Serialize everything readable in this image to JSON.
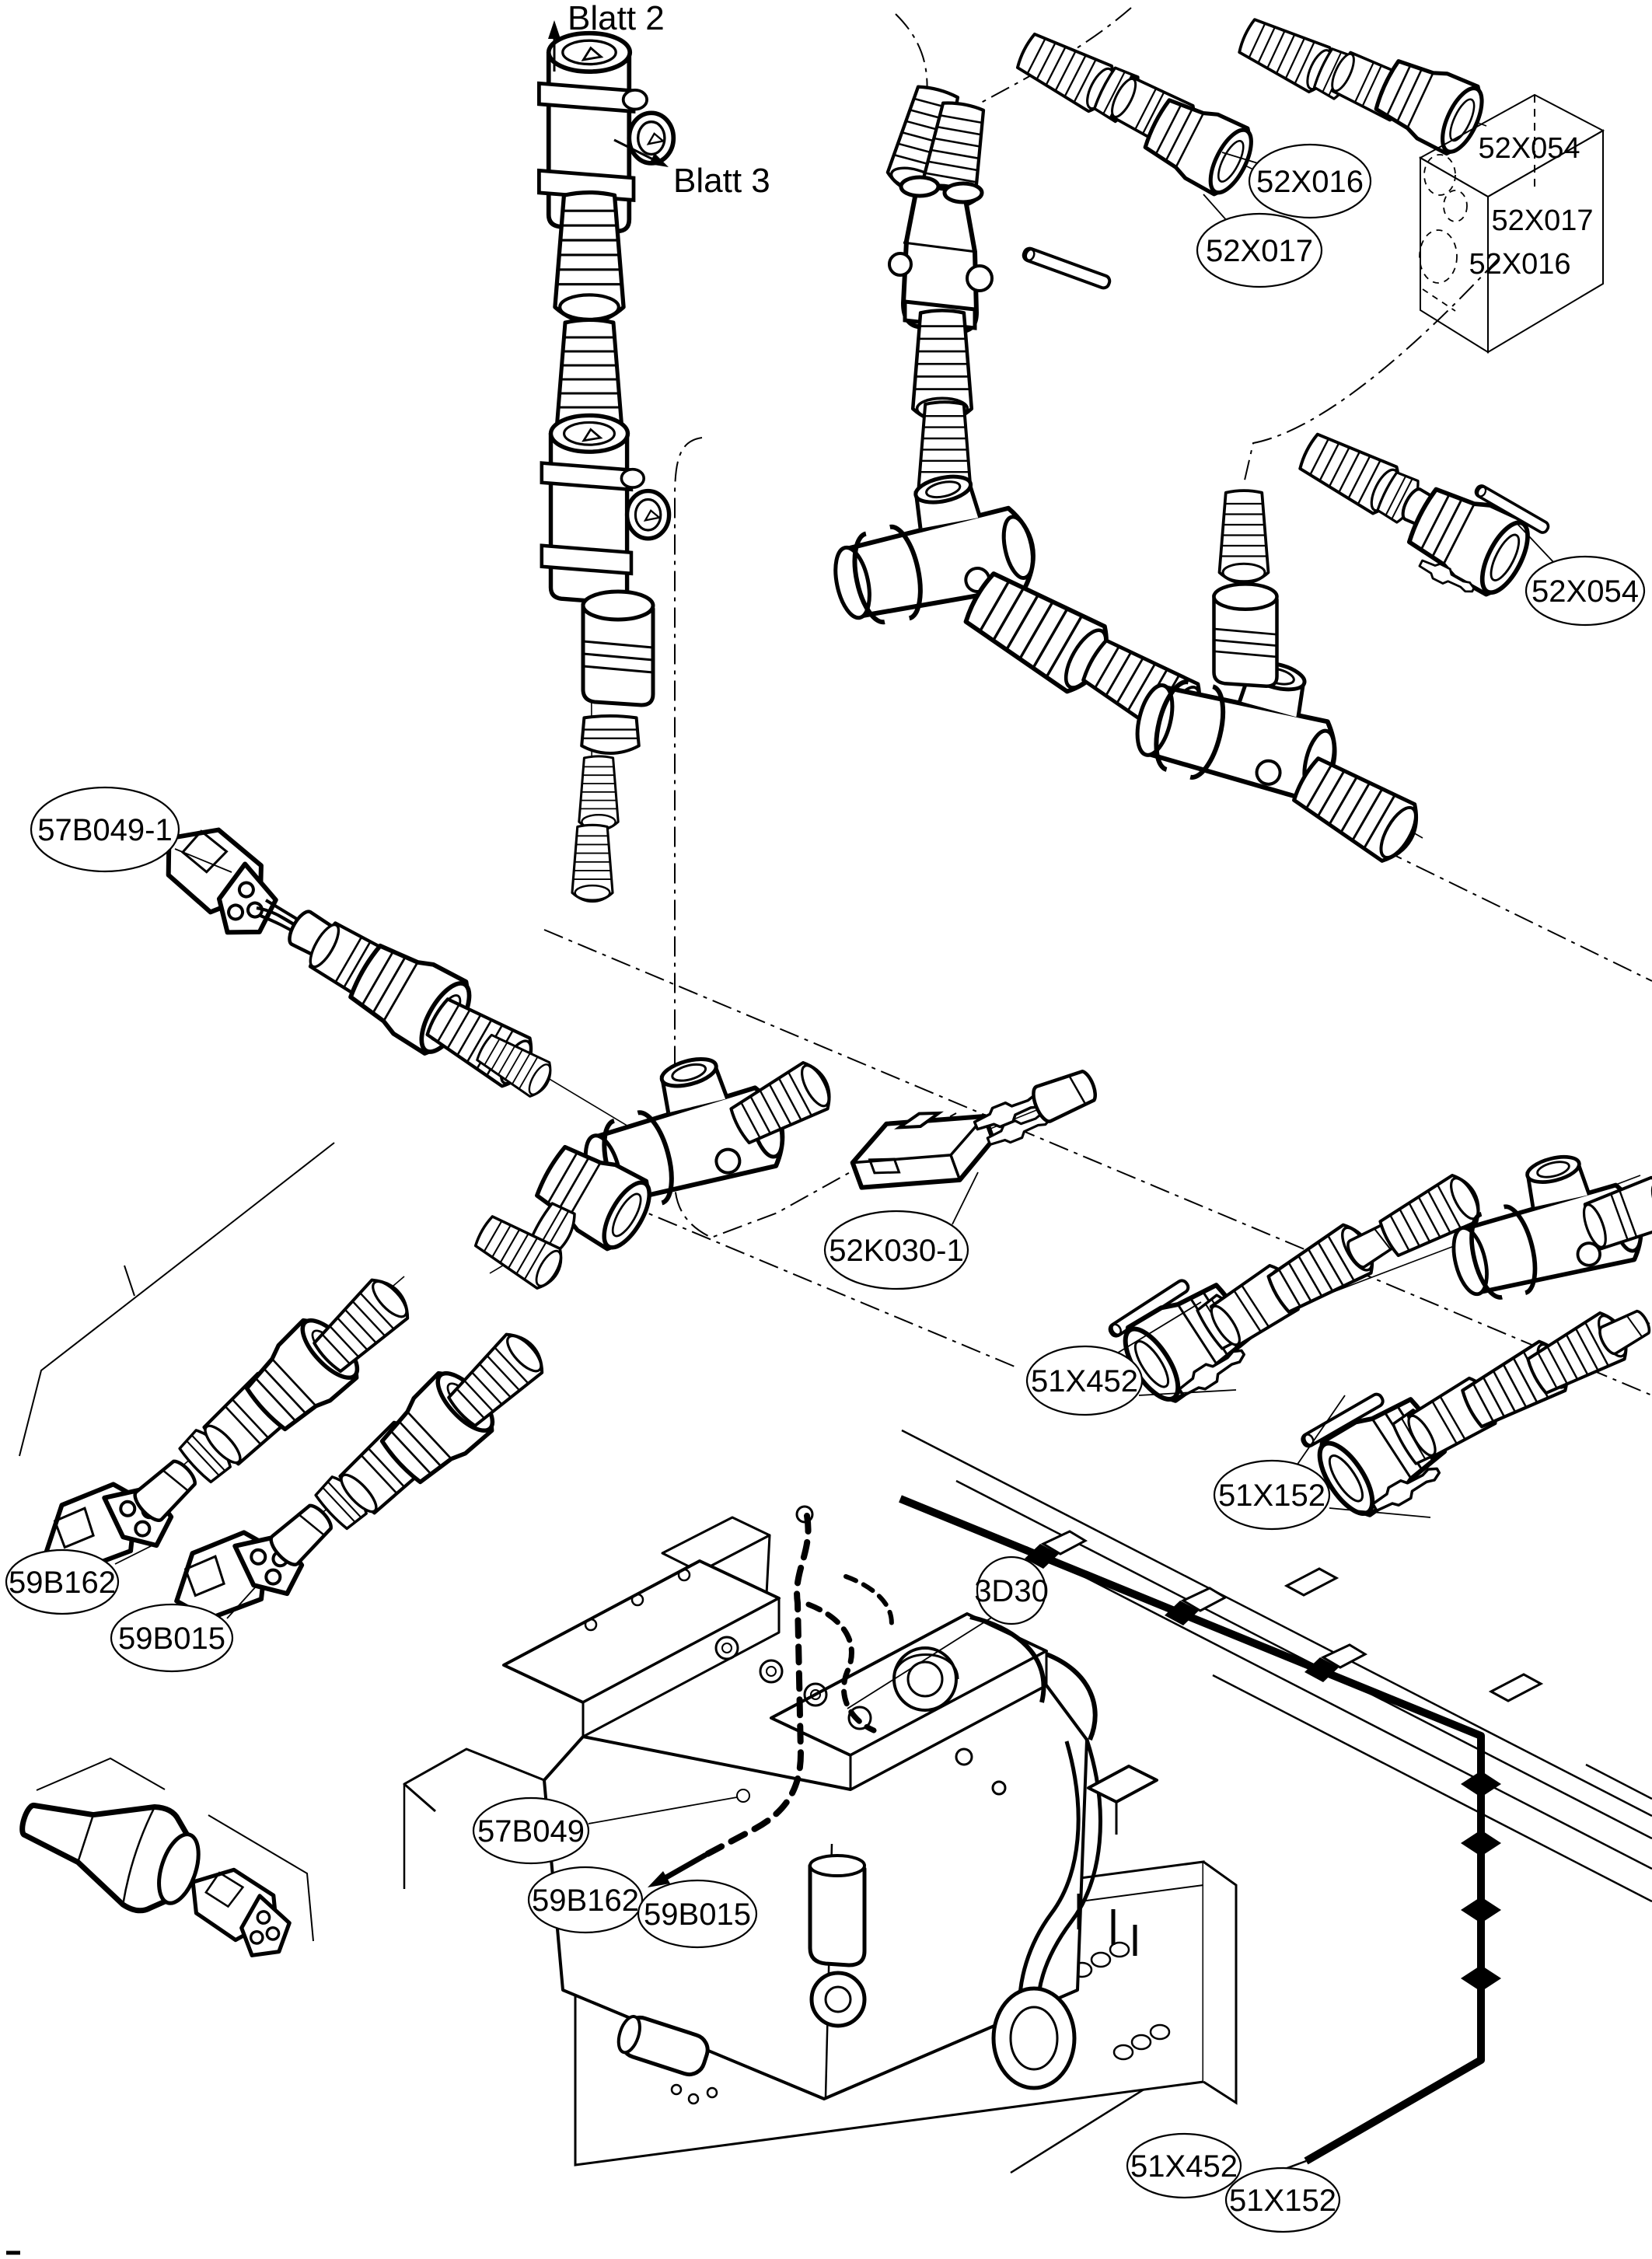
{
  "diagram": {
    "kind": "exploded-parts-wiring-diagram",
    "background": "#ffffff",
    "line_color": "#000000",
    "sheet_refs": {
      "blatt2": "Blatt 2",
      "blatt3": "Blatt 3"
    },
    "inset_box": {
      "labels": [
        "52X054",
        "52X017",
        "52X016"
      ]
    },
    "callouts": [
      {
        "id": "52X016-top",
        "text": "52X016"
      },
      {
        "id": "52X017-top",
        "text": "52X017"
      },
      {
        "id": "52X054-right",
        "text": "52X054"
      },
      {
        "id": "57B049-1-left",
        "text": "57B049-1"
      },
      {
        "id": "52K030-1-mid",
        "text": "52K030-1"
      },
      {
        "id": "51X452-mid",
        "text": "51X452"
      },
      {
        "id": "51X152-mid",
        "text": "51X152"
      },
      {
        "id": "59B162-left",
        "text": "59B162"
      },
      {
        "id": "59B015-left",
        "text": "59B015"
      },
      {
        "id": "3D30-engine",
        "text": "3D30"
      },
      {
        "id": "57B049-engine",
        "text": "57B049"
      },
      {
        "id": "59B162-engine",
        "text": "59B162"
      },
      {
        "id": "59B015-engine",
        "text": "59B015"
      },
      {
        "id": "51X452-bottom",
        "text": "51X452"
      },
      {
        "id": "51X152-bottom",
        "text": "51X152"
      }
    ]
  }
}
